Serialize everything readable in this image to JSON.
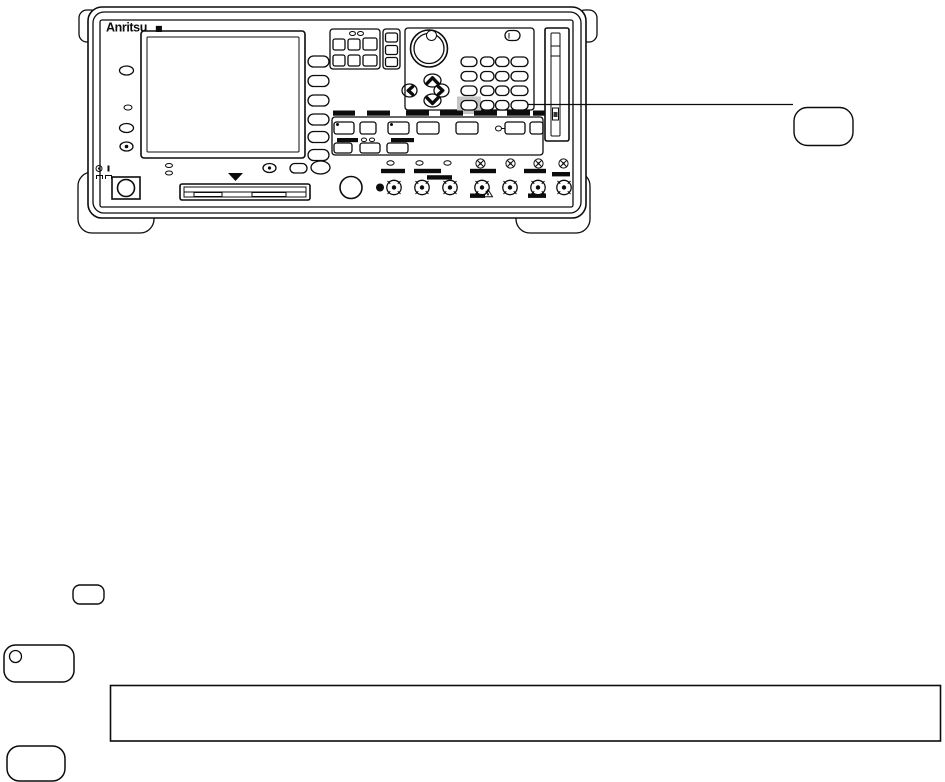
{
  "page": {
    "background_color": "#ffffff",
    "ink_color": "#0c0c0c"
  },
  "instrument": {
    "brand_logo": "Anritsu",
    "logo_mark": "■",
    "highlight_color": "#c5c5c5",
    "softkeys": {
      "count": 6
    },
    "keypad": {
      "rows": 4,
      "cols": 4,
      "highlighted_row": 3,
      "highlighted_col": 0
    },
    "bnc_connectors": {
      "count": 7
    },
    "screw_terminals": {
      "count": 4
    },
    "led_indicators_bottom_row": {
      "count": 3
    }
  },
  "callout": {
    "key_label": ""
  },
  "footer_shapes": {
    "small_key_label": "",
    "led_key_label": "",
    "note_box_text": "",
    "bottom_key_label": ""
  }
}
